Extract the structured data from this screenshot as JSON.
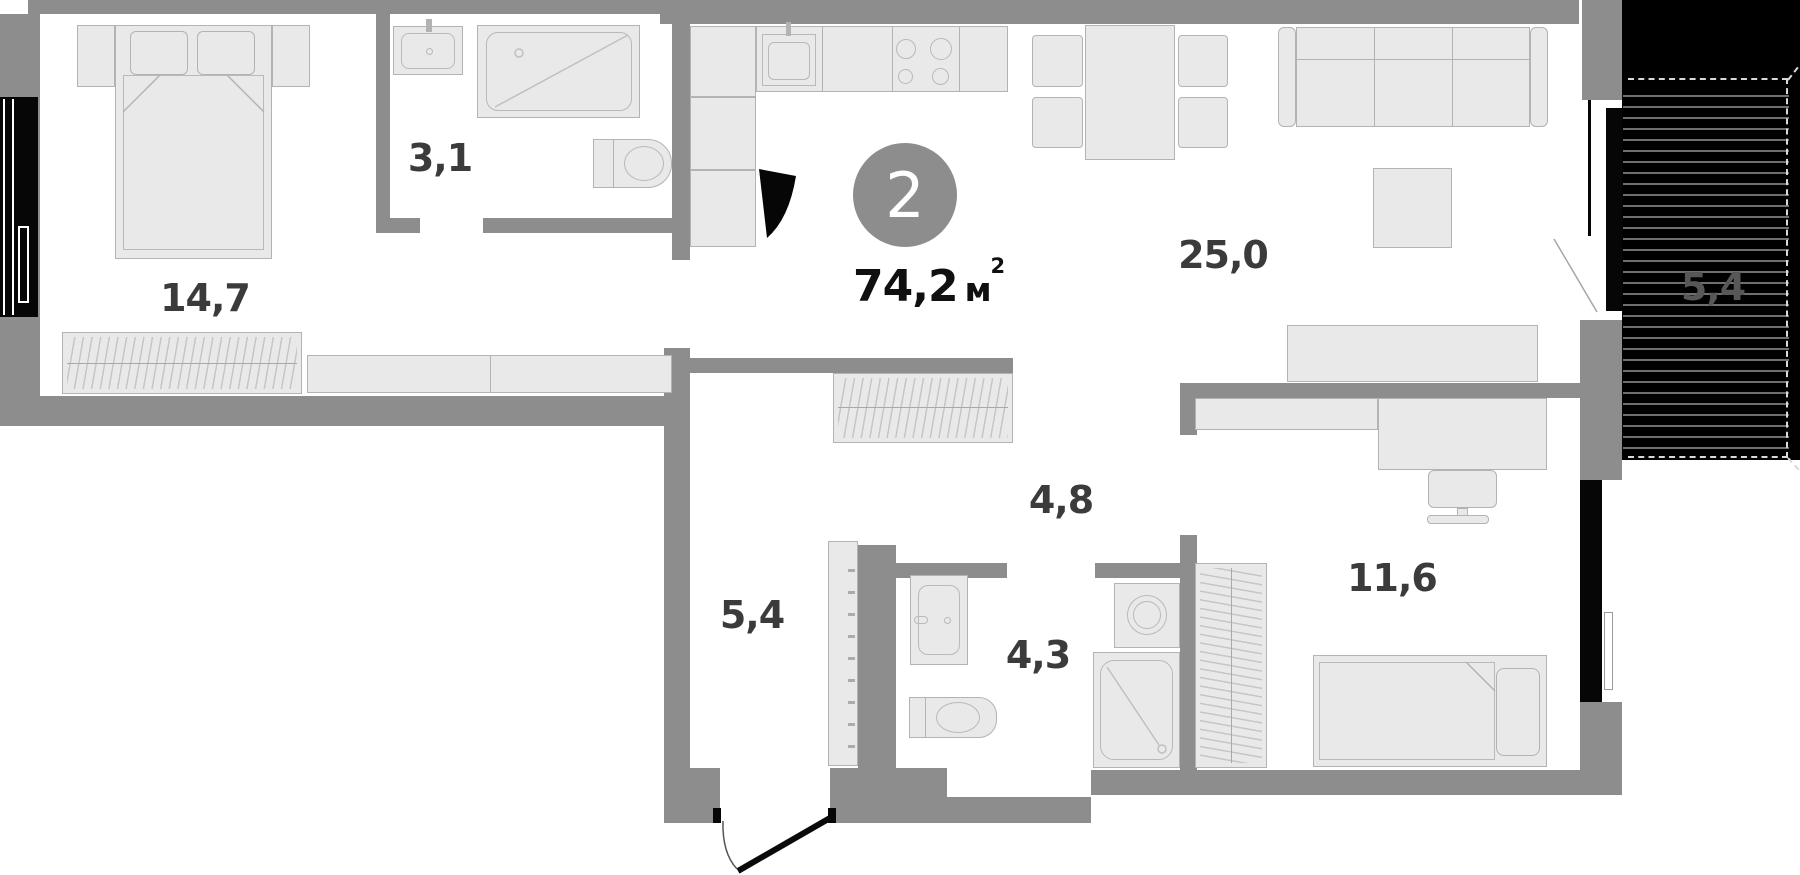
{
  "floor_plan": {
    "badge": {
      "room_count": "2",
      "area_value": "74,2",
      "unit_base": "м",
      "unit_exp": "2"
    },
    "rooms": {
      "bedroom_main": "14,7",
      "bathroom_top": "3,1",
      "kitchen_living": "25,0",
      "hallway": "5,4",
      "corridor": "4,8",
      "bathroom_lower": "4,3",
      "bedroom_second": "11,6",
      "balcony": "5,4"
    },
    "colors": {
      "wall": "#8d8d8d",
      "furniture_fill": "#e9e9e9",
      "furniture_border": "#b3b3b3",
      "window": "#060606",
      "balcony_background": "#000000",
      "balcony_stripe": "#6f6f6f",
      "room_label": "#3b3b3b",
      "balcony_label": "#575757",
      "badge_background": "#8d8d8d",
      "badge_text": "#ffffff",
      "area_text": "#101010"
    }
  }
}
